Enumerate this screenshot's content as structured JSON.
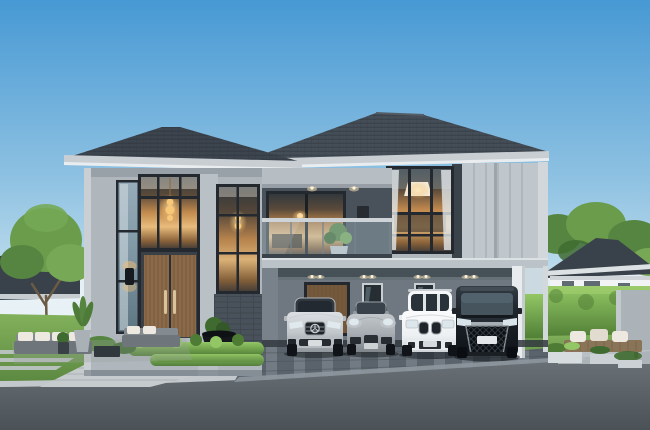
{
  "scene": {
    "title": "Architectural rendering: modern two-storey grey house with four-car carport at dusk",
    "description": "Contemporary hip-roof home with double-height glazed entry and warm interior lighting, balcony with glass railing, large gridded bedroom window, carport holding a silver convertible, a grey roadster, a white SUV and a black luxury minivan; landscaped garden with trees, clipped hedges, outdoor lounge, paver walkway and driveway, neighbouring houses behind",
    "cars": [
      {
        "name": "silver convertible sedan",
        "color_key": "car_silver"
      },
      {
        "name": "grey roadster",
        "color_key": "car_gray"
      },
      {
        "name": "white compact SUV",
        "color_key": "car_white"
      },
      {
        "name": "black luxury minivan",
        "color_key": "car_black"
      }
    ],
    "garden_items": [
      "mature trees",
      "outdoor lounge set",
      "potted plants",
      "dark bowl planter",
      "clipped hedges",
      "timber day-bed with cushions",
      "concrete planter boxes",
      "feature wall"
    ]
  },
  "colors": {
    "sky_top": "#4799D4",
    "sky_mid": "#8FC2E2",
    "sky_low": "#D5E9F2",
    "sky_horizon": "#EDF4F8",
    "roof": "#454E57",
    "roof_left": "#3C444D",
    "roof_line": "#2A3138",
    "ridge": "#555E66",
    "fascia": "#C9CED3",
    "fascia_light": "#E9EDEF",
    "wall_light": "#AFB7BD",
    "wall_lighter": "#B9C0C6",
    "wall_corner": "#C9CFD3",
    "wall_shade": "#8A9299",
    "wall_dark": "#49525A",
    "beam": "#B6BDC3",
    "slab": "#BBC2C8",
    "slab_top": "#DCE1E4",
    "slab_shadow": "#79828A",
    "siding": "#C0C7CC",
    "siding_seam": "#A4ACB2",
    "strip_dark": "#3A424A",
    "corner_trim": "#D2D7DB",
    "frame_dark": "#23292E",
    "glass_dark": "#2E363D",
    "room_dark": "#33383D",
    "room_warm": "#C28A4E",
    "room_glow": "#E9BC7C",
    "room_dim": "#4A4038",
    "glass_cool_a": "#97ACBA",
    "glass_cool_b": "#5E7682",
    "lamp_core": "#FFE9C0",
    "lamp_glow": "#F7C878",
    "downlight": "#FFF6DC",
    "sconce_glow": "#F5BE6F",
    "curtain": "#E2E7EA",
    "lampshade": "#F3E9D9",
    "door_wood": "#8A6A49",
    "door_slat": "#6E5238",
    "handle_gold": "#D8C49A",
    "door_reveal": "#3A4045",
    "brick": "#49525A",
    "brick_line": "#39414A",
    "carport_wall": "#6F7880",
    "carport_side": "#667077",
    "carport_ceiling": "#454E55",
    "carport_floor_shadow": "#31383E",
    "carport_door": "#75593C",
    "pillar_white": "#E9ECEE",
    "pillar_shade": "#C5CBCF",
    "terrace": "#2F363B",
    "planter_bowl": "#14181C",
    "lawn_a": "#82B15B",
    "lawn_b": "#5B8840",
    "hedge_light": "#93C765",
    "hedge_dark": "#4E7C34",
    "tree_a": "#6B9C4C",
    "tree_b": "#558540",
    "tree_c": "#76A855",
    "tree_dark": "#3F6B30",
    "trunk": "#6B5B45",
    "walkway": "#C6CBCE",
    "walkway_joint": "#A6ADB2",
    "paver_strip": "#C0C6CA",
    "driveway": "#5A636B",
    "driveway_light": "#97A0A7",
    "apron": "#8E979E",
    "curb": "#C3C8CC",
    "road_a": "#6E767C",
    "road_b": "#4A5257",
    "neighbor_roof": "#39424A",
    "neighbor_wall": "#F1F3F4",
    "neighbor_fascia": "#DCE1E4",
    "bench_wood": "#8A7458",
    "bench_slat": "#6E5B44",
    "cushion": "#EDE9E0",
    "feature_wall": "#ABB3B8",
    "planter_box": "#D7DCDF",
    "car_silver_hi": "#DCE0E3",
    "car_silver": "#C2C8CC",
    "car_silver_lo": "#8F969C",
    "car_gray_hi": "#C2C7CB",
    "car_gray": "#A8AEB3",
    "car_gray_lo": "#7E858B",
    "car_white_hi": "#FAFBFC",
    "car_white": "#EDF0F2",
    "car_white_lo": "#CED4D7",
    "car_black_hi": "#343C44",
    "car_black": "#1E252B",
    "car_black_lo": "#0E1318",
    "car_glass": "#2A3239",
    "chrome": "#A7AEB4",
    "headlight": "#DFE9EE",
    "tire": "#101418",
    "shadow": "#161B20"
  }
}
